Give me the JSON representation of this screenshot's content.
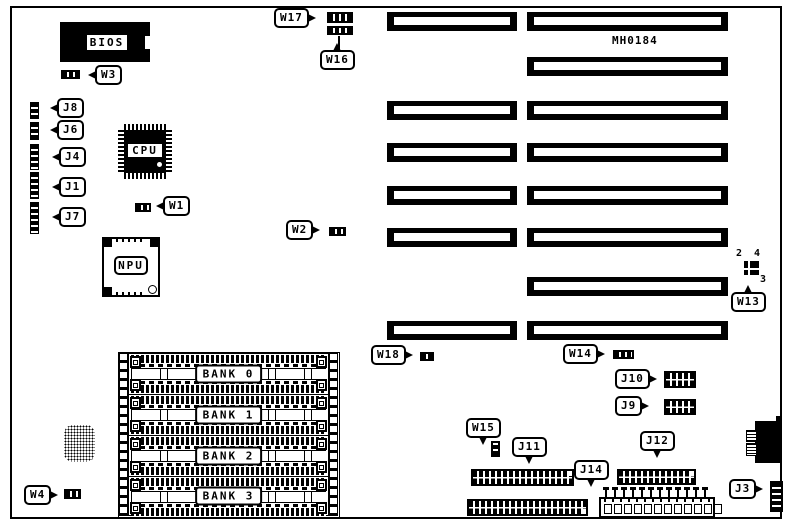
{
  "board": {
    "model_number": "MH0184"
  },
  "chips": {
    "bios": "BIOS",
    "cpu": "CPU",
    "npu": "NPU"
  },
  "memory_banks": [
    {
      "label": "BANK 0"
    },
    {
      "label": "BANK 1"
    },
    {
      "label": "BANK 2"
    },
    {
      "label": "BANK 3"
    }
  ],
  "jumpers": {
    "w1": "W1",
    "w2": "W2",
    "w3": "W3",
    "w4": "W4",
    "w13": "W13",
    "w14": "W14",
    "w15": "W15",
    "w16": "W16",
    "w17": "W17",
    "w18": "W18"
  },
  "connectors": {
    "j1": "J1",
    "j3": "J3",
    "j4": "J4",
    "j6": "J6",
    "j7": "J7",
    "j8": "J8",
    "j9": "J9",
    "j10": "J10",
    "j11": "J11",
    "j12": "J12",
    "j14": "J14"
  },
  "w13_pin_numbers": {
    "pin2": "2",
    "pin4": "4",
    "pin3": "3"
  },
  "expansion_slots": {
    "left_column_count": 6,
    "right_column_count": 8
  },
  "power_connector": {
    "pin_count": 12
  },
  "colors": {
    "ink": "#000000",
    "paper": "#ffffff"
  }
}
